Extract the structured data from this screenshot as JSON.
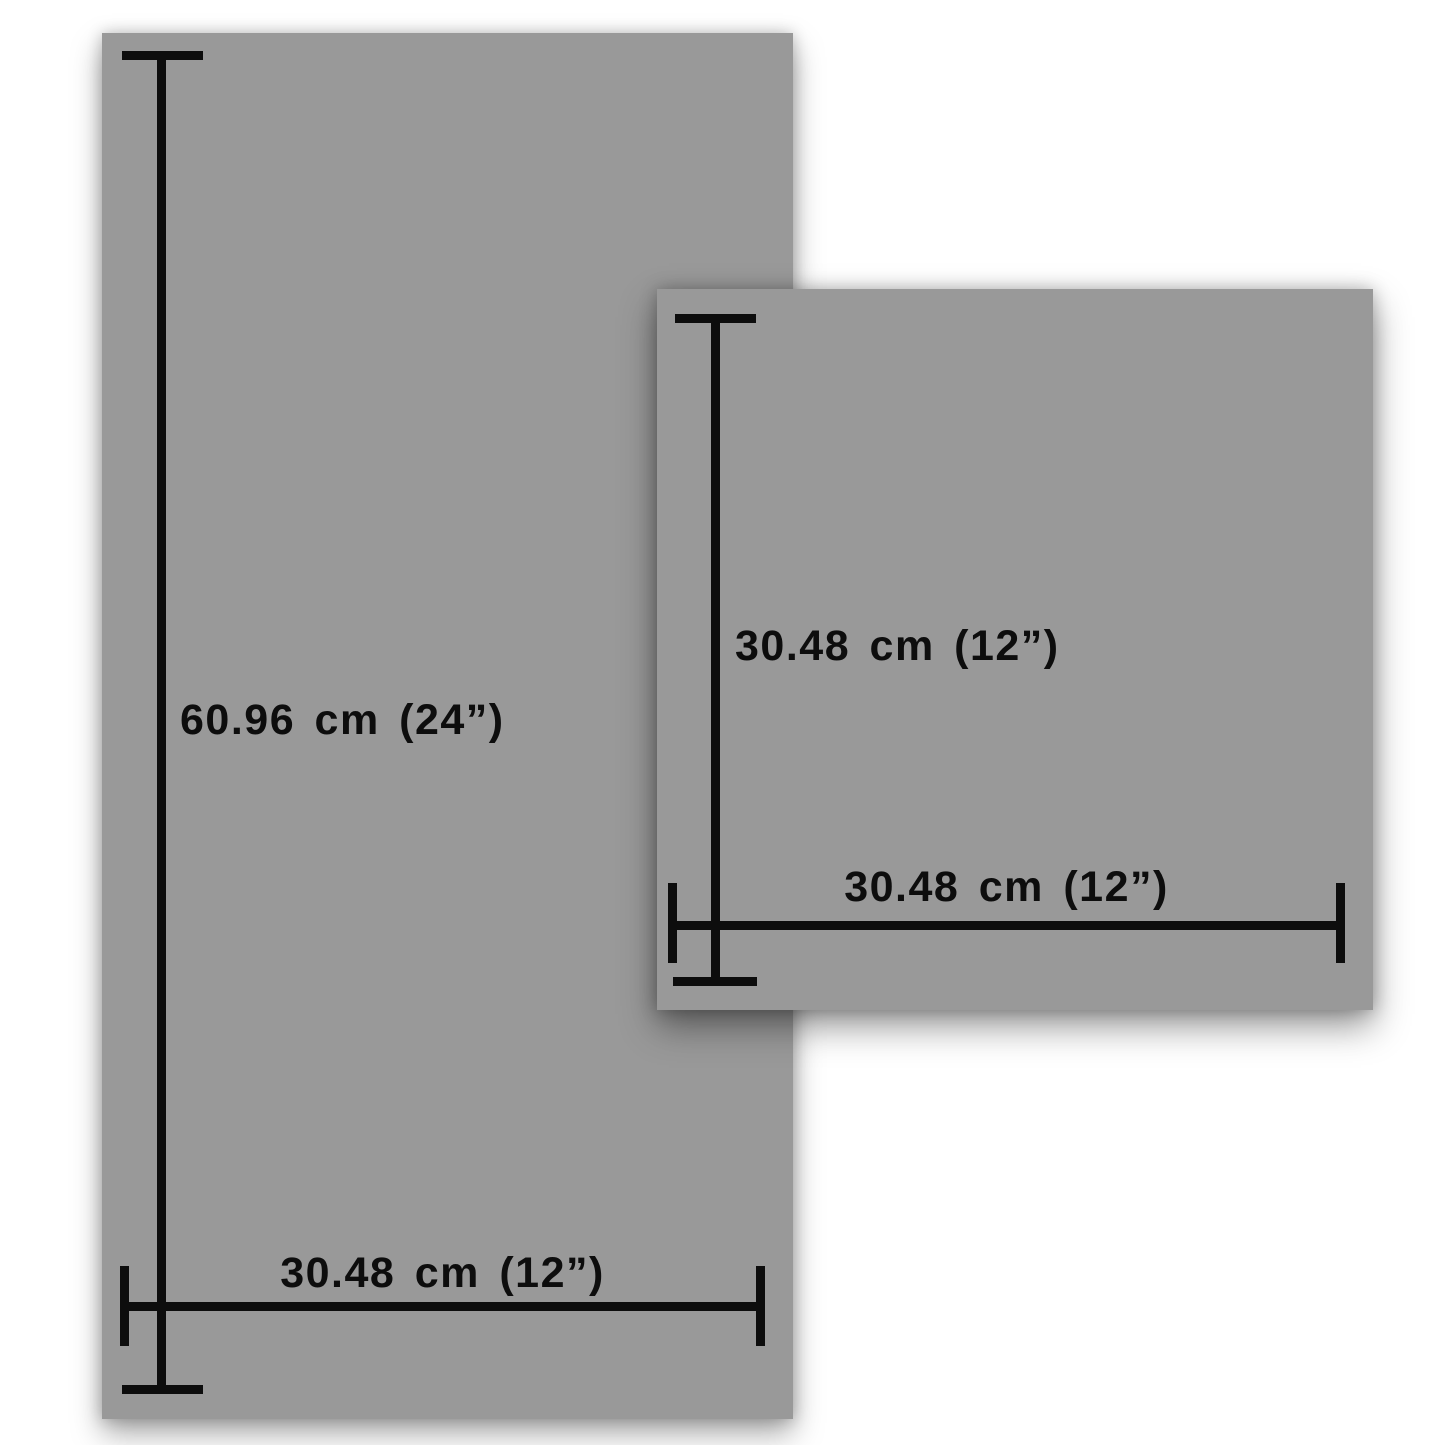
{
  "colors": {
    "background": "#ffffff",
    "panel_gray": "#999999",
    "line_black": "#0d0d0d"
  },
  "panels": [
    {
      "id": "tall-rectangle-panel",
      "height_label": "60.96 cm (24”)",
      "width_label": "30.48 cm (12”)"
    },
    {
      "id": "square-panel",
      "height_label": "30.48 cm (12”)",
      "width_label": "30.48 cm (12”)"
    }
  ]
}
